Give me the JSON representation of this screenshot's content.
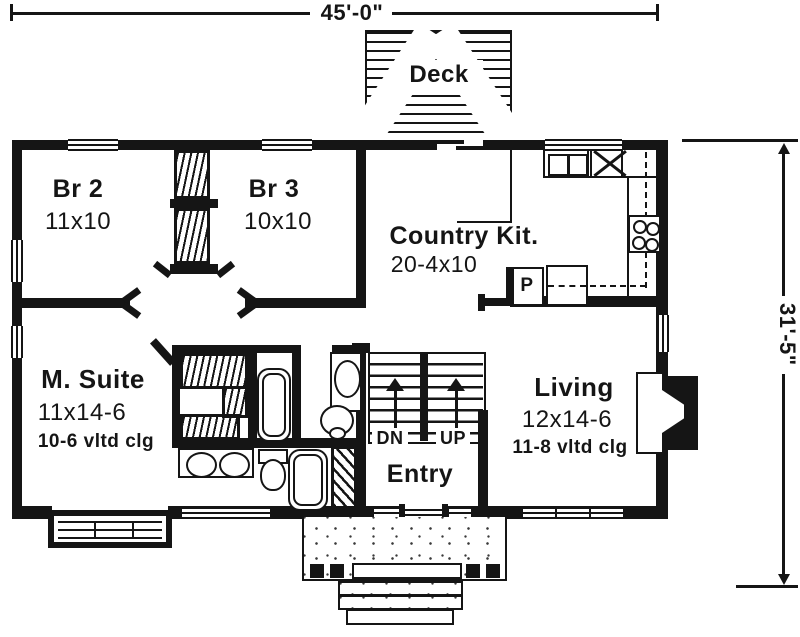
{
  "meta": {
    "drawing_type": "house floor plan (scanned blueprint)",
    "ink_color": "#151515",
    "paper_color": "#ffffff"
  },
  "dimensions": {
    "overall_width": "45'-0\"",
    "overall_depth": "31'-5\""
  },
  "rooms": {
    "deck": {
      "name": "Deck"
    },
    "br2": {
      "name": "Br 2",
      "size": "11x10"
    },
    "br3": {
      "name": "Br 3",
      "size": "10x10"
    },
    "kitchen": {
      "name": "Country Kit.",
      "size": "20-4x10"
    },
    "msuite": {
      "name": "M. Suite",
      "size": "11x14-6",
      "ceiling": "10-6 vltd clg"
    },
    "living": {
      "name": "Living",
      "size": "12x14-6",
      "ceiling": "11-8 vltd clg"
    },
    "entry": {
      "name": "Entry"
    }
  },
  "labels": {
    "stairs_down": "DN",
    "stairs_up": "UP",
    "pantry": "P"
  }
}
